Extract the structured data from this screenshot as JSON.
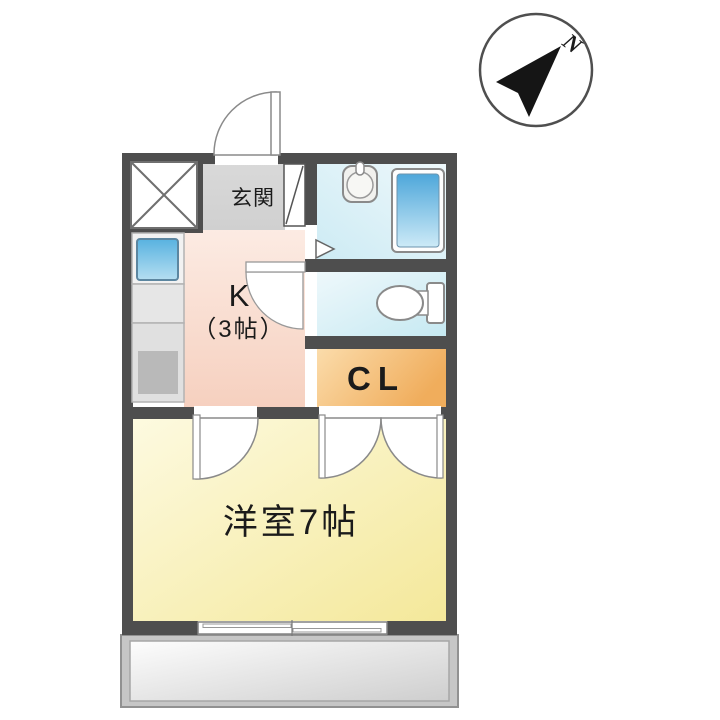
{
  "compass": {
    "north_label": "N"
  },
  "rooms": {
    "entrance": {
      "label": "玄関"
    },
    "kitchen": {
      "label": "K",
      "size_label": "（3帖）"
    },
    "closet": {
      "label": "CL"
    },
    "western_room": {
      "label": "洋室7帖"
    }
  },
  "colors": {
    "wall": "#4e4e4e",
    "entrance_floor": "#d5d5d5",
    "kitchen_floor": "#f8dcce",
    "western_room_floor": "#f7edaa",
    "closet_floor": "#f3bd74",
    "bathroom_floor": "#ddf0f8",
    "toilet_floor": "#d9eef6",
    "bathtub": "#58ace0",
    "kitchen_sink": "#6cbce4",
    "balcony": "#c6c6c6"
  }
}
